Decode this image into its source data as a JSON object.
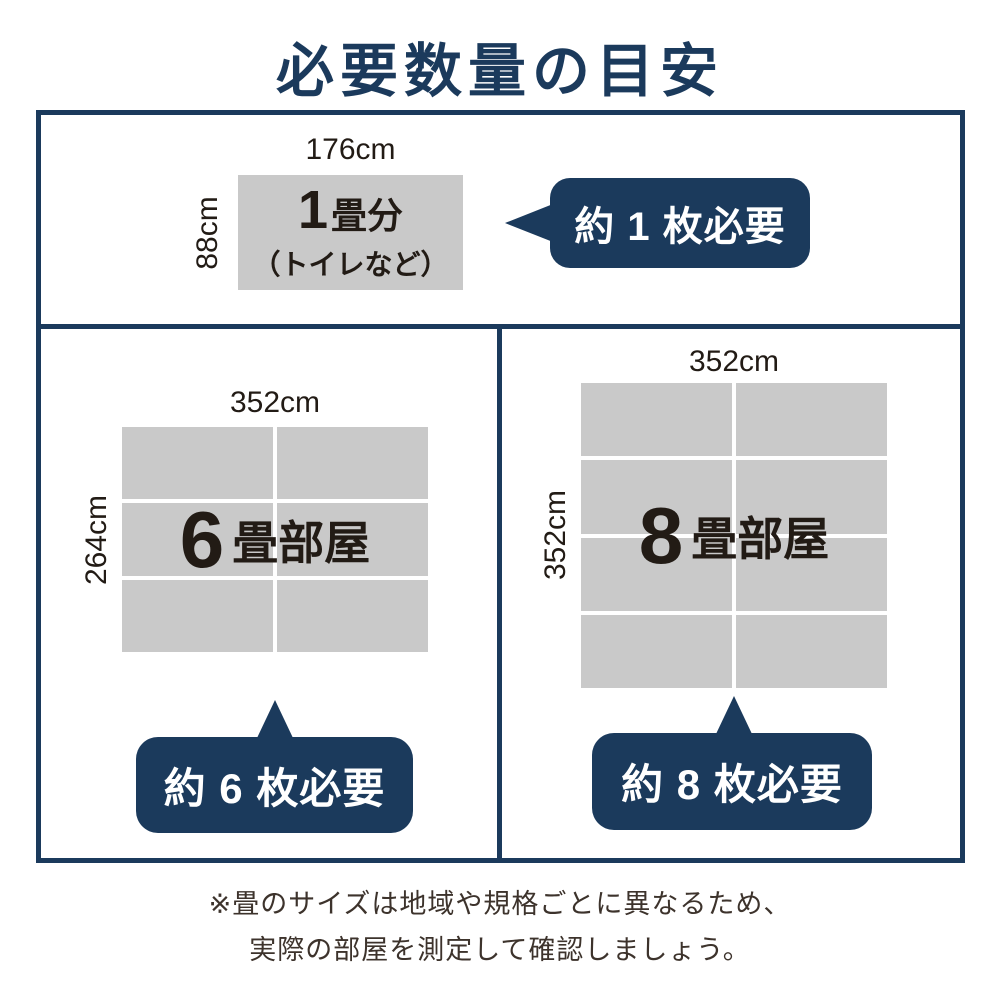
{
  "page": {
    "title": "必要数量の目安",
    "note_line1": "※畳のサイズは地域や規格ごとに異なるため、",
    "note_line2": "実際の部屋を測定して確認しましょう。"
  },
  "colors": {
    "navy": "#1b3a5c",
    "tatami_gray": "#c9c9c9",
    "label_dark": "#221b15",
    "note_text": "#3d332c",
    "callout_text": "#ffffff"
  },
  "sections": {
    "one_tatami": {
      "width_label": "176cm",
      "height_label": "88cm",
      "count": "1",
      "unit_label": "畳分",
      "usage_note": "（トイレなど）",
      "callout": "約 1 枚必要"
    },
    "six_tatami": {
      "width_label": "352cm",
      "height_label": "264cm",
      "count": "6",
      "unit_label": "畳部屋",
      "callout": "約 6 枚必要",
      "grid": {
        "cols": 2,
        "rows": 3
      }
    },
    "eight_tatami": {
      "width_label": "352cm",
      "height_label": "352cm",
      "count": "8",
      "unit_label": "畳部屋",
      "callout": "約 8 枚必要",
      "grid": {
        "cols": 2,
        "rows": 4
      }
    }
  }
}
